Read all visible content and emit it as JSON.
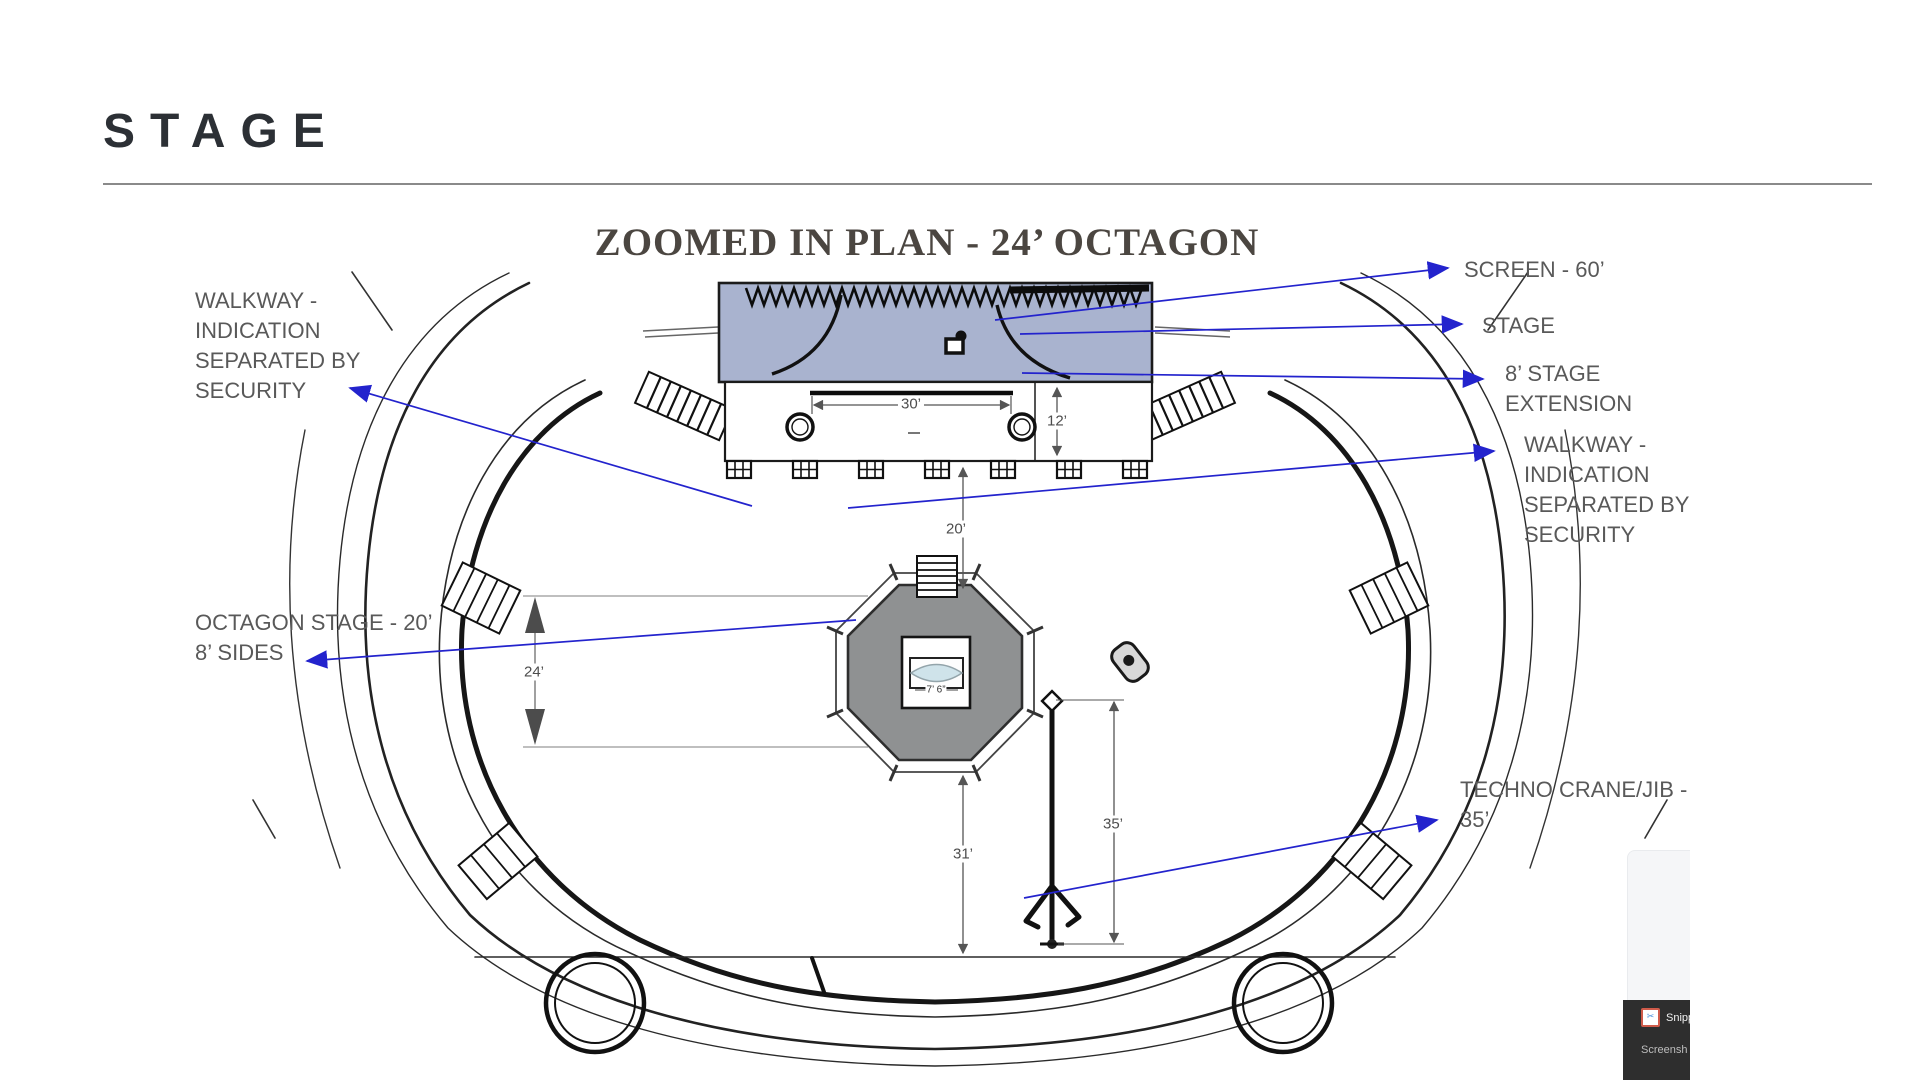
{
  "header": {
    "title": "STAGE"
  },
  "plan": {
    "title": "ZOOMED IN PLAN - 24’ OCTAGON",
    "annotations": {
      "walkway_left": {
        "lines": [
          "WALKWAY -",
          "INDICATION",
          "SEPARATED BY",
          "SECURITY"
        ]
      },
      "screen": {
        "lines": [
          "SCREEN - 60’"
        ]
      },
      "stage": {
        "lines": [
          "STAGE"
        ]
      },
      "stage_extension": {
        "lines": [
          "8’ STAGE",
          "EXTENSION"
        ]
      },
      "walkway_right": {
        "lines": [
          "WALKWAY -",
          "INDICATION",
          "SEPARATED BY",
          "SECURITY"
        ]
      },
      "octagon": {
        "lines": [
          "OCTAGON STAGE - 20’",
          "8’ SIDES"
        ]
      },
      "techno_crane": {
        "lines": [
          "TECHNO CRANE/JIB -",
          "35’"
        ]
      }
    },
    "dimensions": {
      "stage_width": "30’",
      "stage_depth": "12’",
      "octagon_width": "24’",
      "stage_to_octagon": "20’",
      "octagon_to_edge": "31’",
      "crane_height": "35’",
      "table": "7’ 6”"
    },
    "colors": {
      "annotation_arrow": "#2323cd",
      "stage_fill": "#a9b3cf",
      "octagon_fill": "#8f9192",
      "label_text": "#595959"
    }
  },
  "overlay": {
    "snipping_tool": "Snippi",
    "partial": "Screensh"
  }
}
